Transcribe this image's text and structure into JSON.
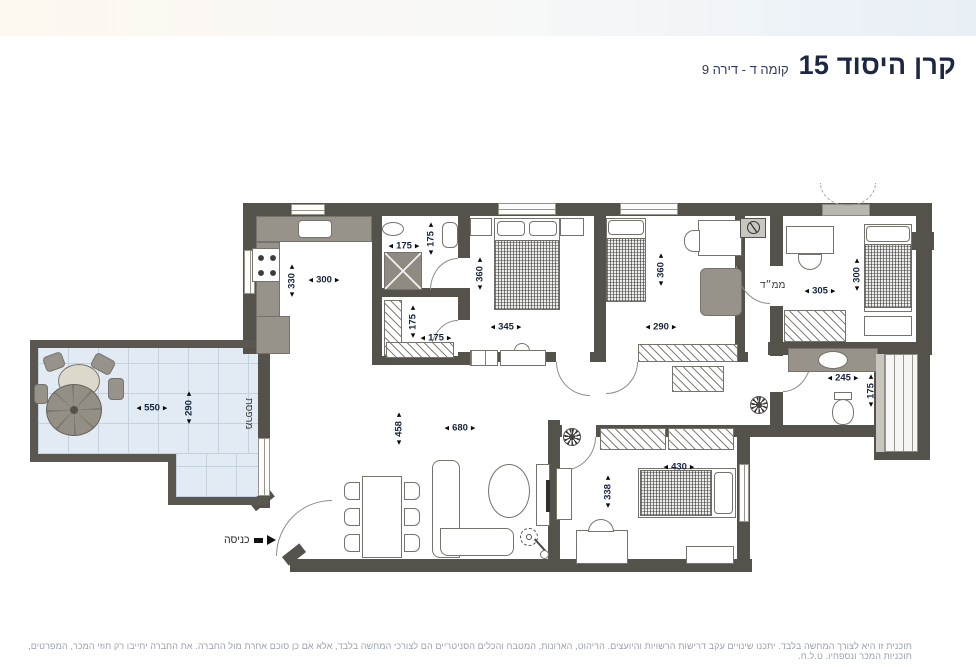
{
  "header": {
    "title": "קרן היסוד 15",
    "subtitle": "קומה ד - דירה 9"
  },
  "plan": {
    "room_labels": {
      "balcony": "מרפסת",
      "mamad": "ממ״ד",
      "entrance": "כניסה"
    },
    "dimensions": {
      "kitchen_w": "300",
      "kitchen_d": "330",
      "shower_w": "175",
      "shower_d": "175",
      "service_w": "175",
      "service_d": "175",
      "bedroom1_w": "345",
      "bedroom1_d": "360",
      "bedroom2_w": "290",
      "bedroom2_d": "360",
      "mamad_w": "305",
      "mamad_d": "300",
      "bathroom_w": "245",
      "bathroom_d": "175",
      "balcony_w": "550",
      "balcony_d": "290",
      "living_w": "680",
      "living_d": "458",
      "bedroom3_w": "430",
      "bedroom3_d": "338"
    }
  },
  "footer": {
    "disclaimer": "תוכנית זו היא לצורך המחשה בלבד. יתכנו שינויים עקב דרישות הרשויות והיועצים. הריהוט, הארונות, המטבח והכלים הסניטריים הם לצורכי המחשה בלבד, אלא אם כן סוכם אחרת מול החברה. את החברה יחייבו רק חוזי המכר, המפרטים, תוכניות המכר ונספחיו. ט.ל.ח."
  }
}
